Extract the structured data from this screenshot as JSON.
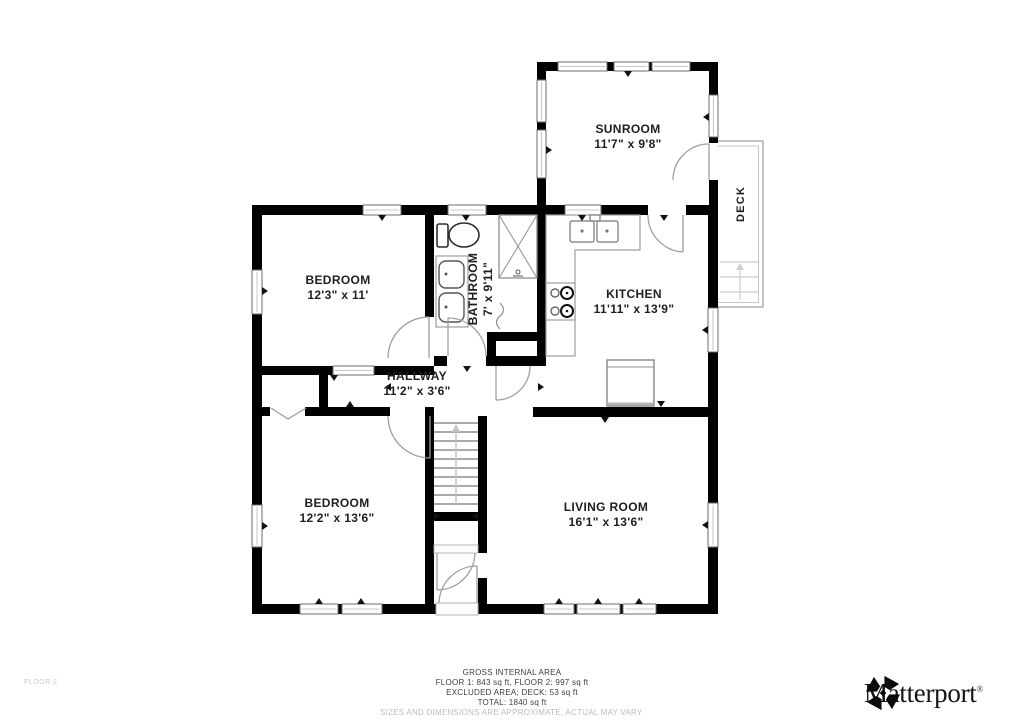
{
  "plan": {
    "floor_label": "FLOOR 2",
    "rooms": {
      "sunroom": {
        "name": "SUNROOM",
        "dims": "11'7\" x 9'8\""
      },
      "bedroom_top": {
        "name": "BEDROOM",
        "dims": "12'3\" x 11'"
      },
      "bathroom": {
        "name": "BATHROOM",
        "dims": "7' x 9'11\""
      },
      "kitchen": {
        "name": "KITCHEN",
        "dims": "11'11\" x 13'9\""
      },
      "hallway": {
        "name": "HALLWAY",
        "dims": "11'2\" x 3'6\""
      },
      "bedroom_bottom": {
        "name": "BEDROOM",
        "dims": "12'2\" x 13'6\""
      },
      "living_room": {
        "name": "LIVING ROOM",
        "dims": "16'1\" x 13'6\""
      },
      "deck": {
        "name": "DECK"
      }
    }
  },
  "footer": {
    "title": "GROSS INTERNAL AREA",
    "areas_line": "FLOOR 1: 843 sq ft, FLOOR 2: 997 sq ft",
    "excluded_line": "EXCLUDED AREA; DECK: 53 sq ft",
    "total_line": "TOTAL: 1840 sq ft",
    "disclaimer": "SIZES AND DIMENSIONS ARE APPROXIMATE, ACTUAL MAY VARY."
  },
  "branding": {
    "wordmark": "Matterport",
    "registered_mark": "®"
  },
  "colors": {
    "wall": "#000000",
    "fixture_line": "#8f8f8f",
    "door_arc": "#9e9e9e",
    "label_text": "#1e1e1e",
    "muted_text": "#bcbcbc",
    "background": "#ffffff"
  }
}
